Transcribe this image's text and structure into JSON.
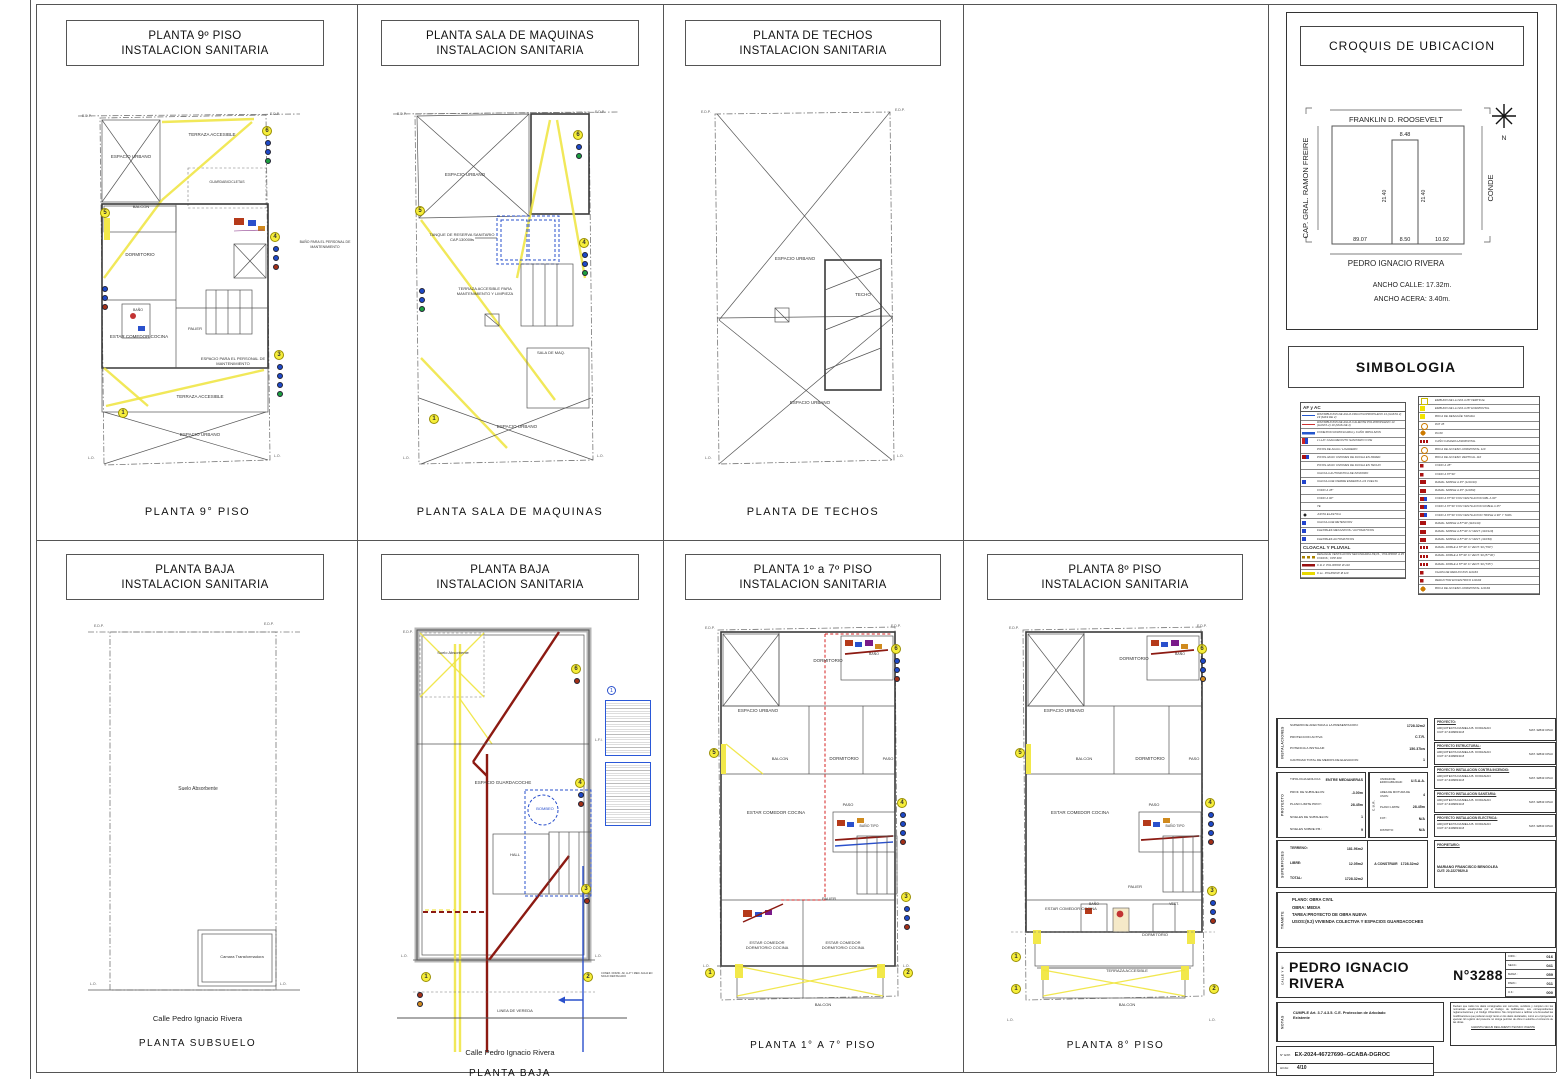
{
  "edges": {
    "edp": "E.D.P.",
    "lo": "L.O.",
    "lfi": "L.F.I.",
    "lv": "LINEA DE VEREDA"
  },
  "panels": [
    {
      "title": [
        "PLANTA 9º PISO",
        "INSTALACION SANITARIA"
      ],
      "caption": "PLANTA  9° PISO",
      "rooms": [
        "ESPACIO URBANO",
        "TERRAZA ACCESIBLE",
        "BALCON",
        "GUARDABICICLETAS",
        "DORMITORIO",
        "BAÑO",
        "ESTAR COMEDOR COCINA",
        "PALIER",
        "BAÑO PARA EL PERSONAL DE MANTENIMIENTO",
        "ESPACIO PARA EL PERSONAL DE MANTENIMIENTO",
        "TERRAZA ACCESIBLE",
        "ESPACIO URBANO"
      ],
      "markers": [
        "6",
        "5",
        "4",
        "3",
        "1"
      ]
    },
    {
      "title": [
        "PLANTA SALA DE MAQUINAS",
        "INSTALACION SANITARIA"
      ],
      "caption": "PLANTA SALA DE MAQUINAS",
      "rooms": [
        "ESPACIO URBANO",
        "TANQUE DE RESERVA SANITARIO CAP.13000lts",
        "TERRAZA ACCESIBLE PARA MANTENIMIENTO Y LIMPIEZA",
        "SALA DE MAQ.",
        "ESPACIO URBANO"
      ],
      "markers": [
        "6",
        "5",
        "4",
        "1"
      ]
    },
    {
      "title": [
        "PLANTA DE TECHOS",
        "INSTALACION SANITARIA"
      ],
      "caption": "PLANTA DE TECHOS",
      "rooms": [
        "ESPACIO URBANO",
        "TECHO",
        "ESPACIO URBANO"
      ],
      "markers": []
    },
    {
      "title": [
        "PLANTA  BAJA",
        "INSTALACION SANITARIA"
      ],
      "caption": "PLANTA SUBSUELO",
      "street": "Calle Pedro Ignacio Rivera",
      "rooms": [
        "Suelo Absorbente",
        "Camara Transformadora"
      ],
      "markers": []
    },
    {
      "title": [
        "PLANTA  BAJA",
        "INSTALACION SANITARIA"
      ],
      "caption": "PLANTA BAJA",
      "street": "Calle Pedro Ignacio Rivera",
      "rooms": [
        "Suelo Absorbente",
        "ESPACIO GUARDACOCHE",
        "BOMBEO",
        "HALL"
      ],
      "markers": [
        "6",
        "4",
        "3",
        "1",
        "2"
      ],
      "callout": "1",
      "note": "CONEX. DOMIC. AF, LLP Y MED. AGUA EN NICHO DESTACADO"
    },
    {
      "title": [
        "PLANTA 1º  a 7º PISO",
        "INSTALACION SANITARIA"
      ],
      "caption": "PLANTA  1° A 7° PISO",
      "rooms": [
        "ESPACIO URBANO",
        "DORMITORIO",
        "BAÑO",
        "BALCON",
        "DORMITORIO",
        "PASO",
        "ESTAR COMEDOR COCINA",
        "PASO",
        "BAÑO TIPO",
        "PALIER",
        "ESTAR COMEDOR DORMITORIO COCINA",
        "ESTAR COMEDOR DORMITORIO COCINA",
        "BALCON"
      ],
      "markers": [
        "6",
        "5",
        "4",
        "3",
        "1",
        "2"
      ]
    },
    {
      "title": [
        "PLANTA 8º PISO",
        "INSTALACION SANITARIA"
      ],
      "caption": "PLANTA  8° PISO",
      "rooms": [
        "ESPACIO URBANO",
        "DORMITORIO",
        "BAÑO",
        "BALCON",
        "DORMITORIO",
        "PASO",
        "ESTAR COMEDOR COCINA",
        "PASO",
        "BAÑO TIPO",
        "PALIER",
        "ESTAR COMEDOR COCINA",
        "BAÑO",
        "VEST.",
        "DORMITORIO",
        "TERRAZA ACCESIBLE",
        "BALCON"
      ],
      "markers": [
        "6",
        "5",
        "4",
        "3",
        "1",
        "2"
      ]
    }
  ],
  "croquis": {
    "title": "CROQUIS DE UBICACION",
    "streets": {
      "top": "FRANKLIN D. ROOSEVELT",
      "left": "CAP. GRAL. RAMON FREIRE",
      "right": "CONDE",
      "bottom": "PEDRO IGNACIO RIVERA"
    },
    "dims": {
      "front_top": "8.48",
      "depth_left": "21.40",
      "depth_right": "21.40",
      "offset_left": "89.07",
      "front_bottom": "8.50",
      "offset_right": "10.92"
    },
    "north": "N",
    "notes": [
      "ANCHO CALLE: 17.32m.",
      "ANCHO ACERA:  3.40m."
    ]
  },
  "simbologia": {
    "title": "SIMBOLOGIA",
    "af_ac": {
      "header": "AF  y  AC",
      "rows": [
        {
          "sym": "lineblue",
          "text": "DISTRIBUCION DE AGUA FRIA POLIPROPILENO 13 (HASTA 2)  19 (MAS DE 2)"
        },
        {
          "sym": "linered",
          "text": "DISTRIBUCION DE AGUA CALIENTE POLIPROPILENO 13 (HASTA 2)  19 (MAS DE 2)"
        },
        {
          "sym": "linebluethick",
          "text": "CONEXION DOMICILIARIA y CAÑO IMPULSION"
        },
        {
          "sym": "llp",
          "text": "1 LL/P. CADA RECINTO SANITARIO O PE"
        },
        {
          "sym": "none",
          "text": "PICOS DE AGUA / LAVADERO"
        },
        {
          "sym": "redblue",
          "text": "PICOS AF/AC UNIONES DE DUCHA EN PARED"
        },
        {
          "sym": "none",
          "text": "PICOS AF/AC UNIONES DE DUCHA EN TECHO"
        },
        {
          "sym": "none",
          "text": "VALVULA AUTOMATICA DE INODORO"
        },
        {
          "sym": "bluemark",
          "text": "VALVULA DE CIERRE ESFERICA 1/4  VUELTA"
        },
        {
          "sym": "none",
          "text": "CODO A 45°"
        },
        {
          "sym": "none",
          "text": "CODO A 90°"
        },
        {
          "sym": "none",
          "text": "TE"
        },
        {
          "sym": "dotblack",
          "text": "JUNTA ELASTICA"
        },
        {
          "sym": "bluemark",
          "text": "VALVULA DE RETENCION"
        },
        {
          "sym": "bluemark",
          "text": "FLEXIBLES MECANICOS  / AUTOMATICOS"
        },
        {
          "sym": "bluemark",
          "text": "FLEXIBLES AUTOMATICOS"
        }
      ]
    },
    "cloacal": {
      "header": "CLOACAL  Y  PLUVIAL",
      "rows": [
        {
          "sym": "dashbrown",
          "text": "DESAGÜE VENTILACION SECUNDARIA PE,PL ;  POLIPROP. A 45  CODOS ;  CPP 400"
        },
        {
          "sym": "linedarkred",
          "text": "C.D.V.   POLIPROP. Ø 110"
        },
        {
          "sym": "lineyellow",
          "text": "C.LL.  POLIPROP. Ø 110"
        }
      ]
    },
    "right": {
      "rows": [
        {
          "sym": "sqyellow",
          "text": "EMBUDO DE LLUVIA A PP VERTICAL"
        },
        {
          "sym": "sqyellowfill",
          "text": "EMBUDO DE LLUVIA A PP HORIZONTAL"
        },
        {
          "sym": "sqyellowfill",
          "text": "BOCA DE DESAGÜE TAPADA"
        },
        {
          "sym": "circorange",
          "text": "PAT 45"
        },
        {
          "sym": "circorangefill",
          "text": "PA 60"
        },
        {
          "sym": "redooo",
          "text": "CAÑO CAMARA HORIZONTAL"
        },
        {
          "sym": "circorange",
          "text": "BOCA DE ACCESO HORIZONTAL 110"
        },
        {
          "sym": "circorange",
          "text": "BOCA DE ACCESO VERTICAL 110"
        },
        {
          "sym": "redsmall",
          "text": "CODO A 45°"
        },
        {
          "sym": "redsmall",
          "text": "CODO A 87°30'"
        },
        {
          "sym": "redmark",
          "text": "RAMAL SIMPLE A 45°  (110/110)"
        },
        {
          "sym": "redmark",
          "text": "RAMAL SIMPLE A 45°  (110/63)"
        },
        {
          "sym": "redblue",
          "text": "CODO A 87°30' CON VENTILACION DBL A 90°"
        },
        {
          "sym": "redblue",
          "text": "CODO A 87°30' CON VENTILACION DOBLE A 45°"
        },
        {
          "sym": "redblue",
          "text": "CODO A 87°30' CON VENTILACION TRIPLE A 90° Y TAPA"
        },
        {
          "sym": "redmark",
          "text": "RAMAL SIMPLE A 87°30'  (110/110)"
        },
        {
          "sym": "redmark",
          "text": "RAMAL SIMPLE A 87°30' C/ VENT.  (110/110)"
        },
        {
          "sym": "redmark",
          "text": "RAMAL SIMPLE A 87°30' C/ VENT.  (110/63)"
        },
        {
          "sym": "redooo",
          "text": "RAMAL DOBLE A 87°30' C/ VENT. 90  (T90°)"
        },
        {
          "sym": "redooo",
          "text": "RAMAL DOBLE A 87°30' C/ VENT. 90  (87°30')"
        },
        {
          "sym": "redooo",
          "text": "RAMAL DOBLE A 87°30' C/ VENT. 90  (T45°)"
        },
        {
          "sym": "redsmall",
          "text": "CHAPA DE REDUCCION 110x63"
        },
        {
          "sym": "redsmall",
          "text": "REDUCTOR EXCENTRICO 110x63"
        },
        {
          "sym": "circorangefill",
          "text": "BOCA DE ACCESO HORIZONTAL 110x63"
        }
      ]
    }
  },
  "titleblock": {
    "instalaciones": {
      "label": "INSTALACIONES",
      "rows": [
        [
          "SUPERFICIE AFECTADA A LA PRESENTACION:",
          "1728.32m2"
        ],
        [
          "PROTECCION ACTIVA:",
          "C.T.R."
        ],
        [
          "POTENCIA A INSTALAR:",
          "150.37kw"
        ],
        [
          "CANTIDAD TOTAL DE MEDIOS DE ELEVACION:",
          "1"
        ]
      ]
    },
    "proyecto": {
      "label": "PROYECTO",
      "rows": [
        [
          "TIPOLOGIA EDILICIA:",
          "ENTRE MEDIANERAS"
        ],
        [
          "PROF. DE SUBSUELOS:",
          "-3.00m"
        ],
        [
          "PLANO LIMITE PROY.:",
          "28.45m"
        ],
        [
          "NIVELES DE SUBSUELOS:",
          "1"
        ],
        [
          "NIVELES SOBRE P.B.:",
          "9"
        ]
      ]
    },
    "cur": {
      "label": "C.U.R.",
      "cpu": "C.P.U.",
      "rows": [
        [
          "UNIDAD DE EDIFICABILIDAD:",
          "U.S.A.A."
        ],
        [
          "AREA DE MIXTURA DE USOS:",
          "4"
        ],
        [
          "PLANO LIMITE:",
          "28.45m"
        ],
        [
          "FOT.:",
          "N/A"
        ],
        [
          "DISTRITO:",
          "N/A"
        ]
      ]
    },
    "superficies": {
      "label": "SUPERFICIES",
      "rows": [
        [
          "TERRENO:",
          "181.96m2"
        ],
        [
          "LIBRE:",
          "12.05m2"
        ],
        [
          "TOTAL:",
          "1728.32m2"
        ]
      ],
      "aconstruir_label": "A CONSTRUIR",
      "aconstruir": "1728.32m2"
    },
    "profesionales": [
      {
        "heading": "PROYECTO:",
        "name": "ARQUITECTA DANIELA B. KODJAIAN",
        "cuit": "CUIT 27-34098133-8",
        "mat": "MAT. 32843 CPAU"
      },
      {
        "heading": "PROYECTO ESTRUCTURAL:",
        "name": "ARQUITECTA DANIELA B. KODJAIAN",
        "cuit": "CUIT 27-34098133-8",
        "mat": "MAT. 32843 CPAU"
      },
      {
        "heading": "PROYECTO INSTALACION CONTRA INCENDIO:",
        "name": "ARQUITECTA DANIELA B. KODJAIAN",
        "cuit": "CUIT 27-34098133-8",
        "mat": "MAT. 32843 CPAU"
      },
      {
        "heading": "PROYECTO INSTALACION SANITARIA:",
        "name": "ARQUITECTA DANIELA B. KODJAIAN",
        "cuit": "CUIT 27-34098133-8",
        "mat": "MAT. 32843 CPAU"
      },
      {
        "heading": "PROYECTO INSTALACION ELECTRICA:",
        "name": "ARQUITECTA DANIELA B. KODJAIAN",
        "cuit": "CUIT 27-34098133-8",
        "mat": "MAT. 32843 CPAU"
      }
    ],
    "propietario": {
      "heading": "PROPIETARIO:",
      "name": "MARIANO FRANCISCO BENGOLEA",
      "cuit": "CUIT: 20-22279529-8"
    },
    "tramite": {
      "label": "TRAMITE",
      "lines": [
        "PLANO: OBRA CIVIL",
        "OBRA: MEDIA",
        "TAREA:PROYECTO DE OBRA NUEVA",
        "USOS:(9.2) VIVIENDA COLECTIVA Y ESPACIOS GUARDACOCHES"
      ]
    },
    "calle": {
      "label": "CALLE Y N°",
      "street": "PEDRO IGNACIO RIVERA",
      "number": "N°3288",
      "catastro": [
        [
          "CIRC.:",
          "016"
        ],
        [
          "SECC.:",
          "041"
        ],
        [
          "MANZ.:",
          "059"
        ],
        [
          "PARC.:",
          "011"
        ],
        [
          "U.F.:",
          "000"
        ]
      ]
    },
    "notas": {
      "label": "NOTAS",
      "text": "CUMPLE Art. 3.7.4.3.5. C.E. Proteccion de Arbolado Existente"
    },
    "declaracion": {
      "text": "Declaro que todos los datos consignados son correctos, veridicos y cumplen con las normativas establecidas por el Codigo de Edificacion, sus correspondientes reglamentaciones y el Codigo Urbanistico. Me comprometo a ratificar a la brevedad las modificaciones que pudieran surgir tanto en los datos declarados, como en el proyecto a ejecutar. El registro del presente no otorga permiso de obra ni autoriza el comienzo de las obras.",
      "footer": "GARANTIA SEGUN REGLAMENTO TECNICO VIGENTE"
    },
    "expediente": {
      "label": "N° EXP.",
      "value": "EX-2024-46727690--GCABA-DGROC",
      "hoja_label": "HOJA:",
      "hoja": "4/10"
    }
  }
}
